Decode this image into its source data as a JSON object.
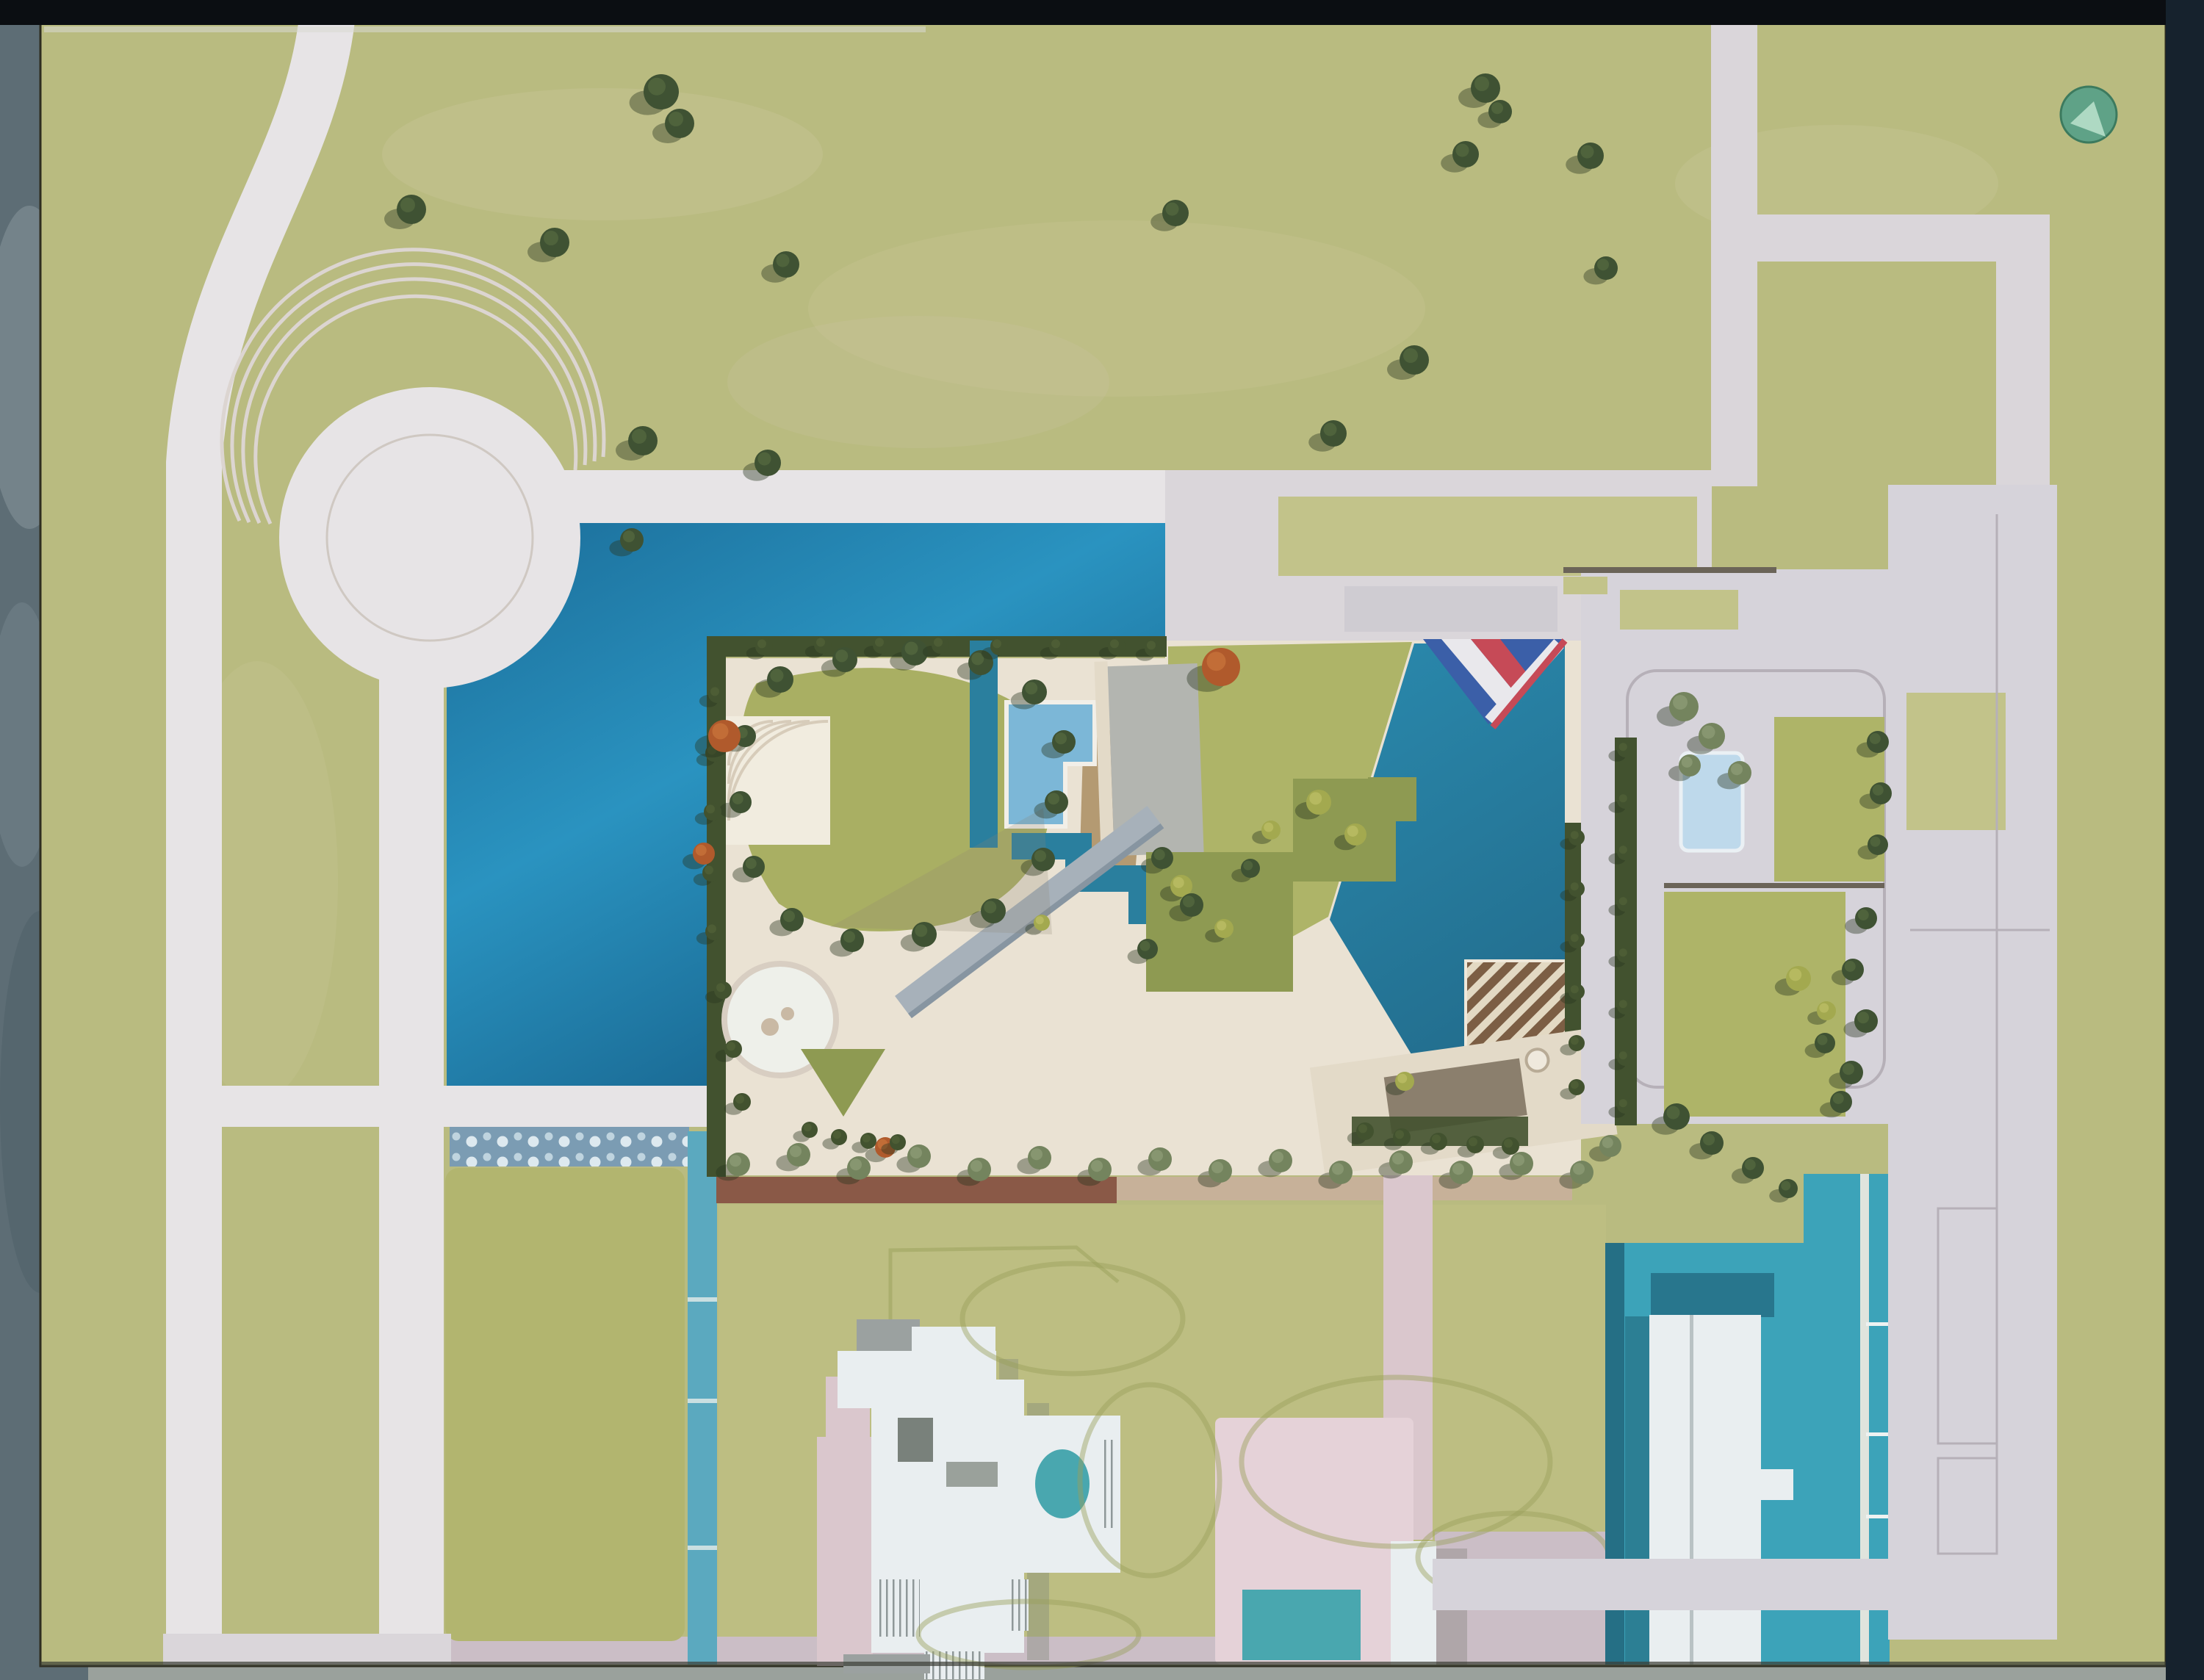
{
  "meta": {
    "subject": "aerial-photograph-of-architectural-site-model",
    "view": "top-down"
  },
  "palette": {
    "granite_left": "#5d6d75",
    "granite_bottom": "#9aa19c",
    "table_top": "#0b0e12",
    "table_right": "#16222d",
    "grass": "#b9bb80",
    "grass_bright": "#c2c38a",
    "grass_block": "#b2b56f",
    "grass_field": "#bdbe82",
    "grass_patch": "#d2cba2",
    "road": "#dad6da",
    "road_bright": "#e7e4e6",
    "road_right": "#d6d3da",
    "road_mauve": "#cbbec6",
    "pink_path": "#dac7cd",
    "pink_court": "#e5d2d8",
    "lake_light": "#2a93c0",
    "lake_mid": "#1b6d99",
    "lake_deep": "#145b84",
    "channel": "#2a7f9e",
    "channel_light": "#5ba9bf",
    "sparkle_base": "#7b9cb3",
    "teal_field": "#3ca3b9",
    "teal_dark": "#256f85",
    "cream": "#eae2d3",
    "cream2": "#e3dac8",
    "white_patch": "#f1ecdf",
    "hedge_dark": "#42522f",
    "hedge_hi": "#55663a",
    "shrub": "#8e9a52",
    "lawn": "#a9af63",
    "lawn2": "#aeb468",
    "pool_blue": "#7cb7d7",
    "pool_pale": "#bed9eb",
    "gray_roof": "#b3b5b0",
    "ramp": "#a7b1ba",
    "sail_blue": "#3b5fa8",
    "sail_red": "#c64a57",
    "sail_white": "#e9e8ec",
    "pergola_brown": "#7c5e44",
    "pergola_cream": "#e3d9c3",
    "wall_brown": "#8a5947",
    "trellis_tan": "#c7b199",
    "tan_patch": "#b49a72",
    "teal_pool": "#49a7af",
    "white_bldg": "#e9eef0",
    "bldg_gray": "#9ba1a0",
    "shadow_gray": "#767d72",
    "disc_teal": "#5fa287",
    "disc_hi": "#aed9c3",
    "tree_dark": "#3f5233",
    "tree_dark_hi": "#5a6f42",
    "tree_gray": "#74845e",
    "tree_gray_hi": "#95a17d",
    "tree_orange": "#b05a2c",
    "tree_orange_hi": "#cf7a3f",
    "tree_yellow": "#a3a94f",
    "tree_yellow_hi": "#c3c46d",
    "tree_shadow": "#27351f",
    "contour": "#99a05a",
    "line_gray": "#b6b0b8",
    "wall_line": "#6b6458"
  },
  "landmarks": [
    "curved-access-road",
    "traffic-circle-plaza",
    "lake-basin",
    "weir-cascade",
    "garden-compound",
    "great-lawn",
    "reflecting-wedge-pool",
    "flag-canopy",
    "pergola-trellis",
    "gray-roof-pavilion",
    "round-patio",
    "diagonal-ramp",
    "east-parcel-court",
    "swimming-pool",
    "plane-tree-allee",
    "hillside-house",
    "spa-terrace",
    "pink-courtyard",
    "courtyard-pool",
    "harbor-basin",
    "white-tower-building",
    "parking-strip",
    "glass-disc-marker"
  ],
  "trees": [
    [
      560,
      285,
      20,
      "dark"
    ],
    [
      755,
      330,
      20,
      "dark"
    ],
    [
      875,
      600,
      20,
      "dark"
    ],
    [
      900,
      125,
      24,
      "dark"
    ],
    [
      925,
      168,
      20,
      "dark"
    ],
    [
      1070,
      360,
      18,
      "dark"
    ],
    [
      1045,
      630,
      18,
      "dark"
    ],
    [
      1600,
      290,
      18,
      "dark"
    ],
    [
      1925,
      490,
      20,
      "dark"
    ],
    [
      1815,
      590,
      18,
      "dark"
    ],
    [
      1995,
      210,
      18,
      "dark"
    ],
    [
      2022,
      120,
      20,
      "dark"
    ],
    [
      2042,
      152,
      16,
      "dark"
    ],
    [
      2165,
      212,
      18,
      "dark"
    ],
    [
      2186,
      365,
      16,
      "dark"
    ],
    [
      860,
      735,
      16,
      "dark"
    ],
    [
      1062,
      925,
      18,
      "dark"
    ],
    [
      1150,
      898,
      17,
      "dark"
    ],
    [
      1245,
      888,
      18,
      "dark"
    ],
    [
      1335,
      902,
      17,
      "dark"
    ],
    [
      1408,
      942,
      17,
      "dark"
    ],
    [
      1448,
      1010,
      16,
      "dark"
    ],
    [
      1438,
      1092,
      16,
      "dark"
    ],
    [
      1420,
      1170,
      16,
      "dark"
    ],
    [
      1352,
      1240,
      17,
      "dark"
    ],
    [
      1258,
      1272,
      17,
      "dark"
    ],
    [
      1160,
      1280,
      16,
      "dark"
    ],
    [
      1078,
      1252,
      16,
      "dark"
    ],
    [
      1026,
      1180,
      15,
      "dark"
    ],
    [
      1008,
      1092,
      15,
      "dark"
    ],
    [
      1014,
      1002,
      15,
      "dark"
    ],
    [
      976,
      945,
      12,
      "hedge"
    ],
    [
      972,
      1025,
      12,
      "hedge"
    ],
    [
      970,
      1105,
      12,
      "hedge"
    ],
    [
      968,
      1188,
      12,
      "hedge"
    ],
    [
      972,
      1268,
      12,
      "hedge"
    ],
    [
      984,
      1348,
      12,
      "hedge"
    ],
    [
      998,
      1428,
      12,
      "hedge"
    ],
    [
      1010,
      1500,
      12,
      "hedge"
    ],
    [
      1040,
      880,
      12,
      "hedge"
    ],
    [
      1120,
      878,
      12,
      "hedge"
    ],
    [
      1200,
      878,
      12,
      "hedge"
    ],
    [
      1280,
      878,
      12,
      "hedge"
    ],
    [
      1360,
      880,
      12,
      "hedge"
    ],
    [
      1440,
      880,
      12,
      "hedge"
    ],
    [
      1520,
      880,
      12,
      "hedge"
    ],
    [
      1570,
      882,
      12,
      "hedge"
    ],
    [
      986,
      1002,
      22,
      "orange"
    ],
    [
      1662,
      908,
      26,
      "orange"
    ],
    [
      958,
      1162,
      15,
      "orange"
    ],
    [
      1205,
      1562,
      14,
      "orange"
    ],
    [
      1795,
      1092,
      17,
      "yellow"
    ],
    [
      1845,
      1136,
      15,
      "yellow"
    ],
    [
      1730,
      1130,
      13,
      "yellow"
    ],
    [
      1608,
      1206,
      15,
      "yellow"
    ],
    [
      1666,
      1264,
      13,
      "yellow"
    ],
    [
      2448,
      1332,
      17,
      "yellow"
    ],
    [
      2486,
      1376,
      13,
      "yellow"
    ],
    [
      1912,
      1472,
      13,
      "yellow"
    ],
    [
      1418,
      1256,
      11,
      "yellow"
    ],
    [
      1582,
      1168,
      15,
      "dark"
    ],
    [
      1622,
      1232,
      16,
      "dark"
    ],
    [
      1562,
      1292,
      14,
      "dark"
    ],
    [
      1702,
      1182,
      13,
      "dark"
    ],
    [
      1005,
      1585,
      16,
      "gray"
    ],
    [
      1087,
      1572,
      16,
      "gray"
    ],
    [
      1169,
      1590,
      16,
      "gray"
    ],
    [
      1251,
      1574,
      16,
      "gray"
    ],
    [
      1333,
      1592,
      16,
      "gray"
    ],
    [
      1415,
      1576,
      16,
      "gray"
    ],
    [
      1497,
      1592,
      16,
      "gray"
    ],
    [
      1579,
      1578,
      16,
      "gray"
    ],
    [
      1661,
      1594,
      16,
      "gray"
    ],
    [
      1743,
      1580,
      16,
      "gray"
    ],
    [
      1825,
      1596,
      16,
      "gray"
    ],
    [
      1907,
      1582,
      16,
      "gray"
    ],
    [
      1989,
      1596,
      16,
      "gray"
    ],
    [
      2071,
      1584,
      16,
      "gray"
    ],
    [
      2153,
      1596,
      16,
      "gray"
    ],
    [
      1858,
      1540,
      12,
      "hedge"
    ],
    [
      1908,
      1548,
      12,
      "hedge"
    ],
    [
      1958,
      1554,
      12,
      "hedge"
    ],
    [
      2008,
      1558,
      12,
      "hedge"
    ],
    [
      2056,
      1560,
      12,
      "hedge"
    ],
    [
      1102,
      1538,
      11,
      "hedge"
    ],
    [
      1142,
      1548,
      11,
      "hedge"
    ],
    [
      1182,
      1553,
      11,
      "hedge"
    ],
    [
      1222,
      1555,
      11,
      "hedge"
    ],
    [
      2292,
      962,
      20,
      "gray"
    ],
    [
      2330,
      1002,
      18,
      "gray"
    ],
    [
      2368,
      1052,
      16,
      "gray"
    ],
    [
      2300,
      1042,
      15,
      "gray"
    ],
    [
      2556,
      1010,
      15,
      "dark"
    ],
    [
      2560,
      1080,
      15,
      "dark"
    ],
    [
      2556,
      1150,
      14,
      "dark"
    ],
    [
      2540,
      1250,
      15,
      "dark"
    ],
    [
      2522,
      1320,
      15,
      "dark"
    ],
    [
      2540,
      1390,
      16,
      "dark"
    ],
    [
      2520,
      1460,
      16,
      "dark"
    ],
    [
      2484,
      1420,
      14,
      "dark"
    ],
    [
      2506,
      1500,
      15,
      "dark"
    ],
    [
      2282,
      1520,
      18,
      "dark"
    ],
    [
      2330,
      1556,
      16,
      "dark"
    ],
    [
      2386,
      1590,
      15,
      "dark"
    ],
    [
      2434,
      1618,
      13,
      "dark"
    ],
    [
      2192,
      1560,
      15,
      "gray"
    ],
    [
      2146,
      1140,
      11,
      "hedge"
    ],
    [
      2146,
      1210,
      11,
      "hedge"
    ],
    [
      2146,
      1280,
      11,
      "hedge"
    ],
    [
      2146,
      1350,
      11,
      "hedge"
    ],
    [
      2146,
      1420,
      11,
      "hedge"
    ],
    [
      2146,
      1480,
      11,
      "hedge"
    ],
    [
      2212,
      1020,
      11,
      "hedge"
    ],
    [
      2212,
      1090,
      11,
      "hedge"
    ],
    [
      2212,
      1160,
      11,
      "hedge"
    ],
    [
      2212,
      1230,
      11,
      "hedge"
    ],
    [
      2212,
      1300,
      11,
      "hedge"
    ],
    [
      2212,
      1370,
      11,
      "hedge"
    ],
    [
      2212,
      1440,
      11,
      "hedge"
    ],
    [
      2212,
      1505,
      11,
      "hedge"
    ]
  ],
  "mounds": [
    [
      1460,
      1795,
      150,
      75
    ],
    [
      1900,
      1990,
      210,
      115
    ],
    [
      2060,
      2120,
      130,
      60
    ],
    [
      1400,
      2225,
      150,
      45
    ],
    [
      1565,
      2015,
      95,
      130
    ]
  ]
}
